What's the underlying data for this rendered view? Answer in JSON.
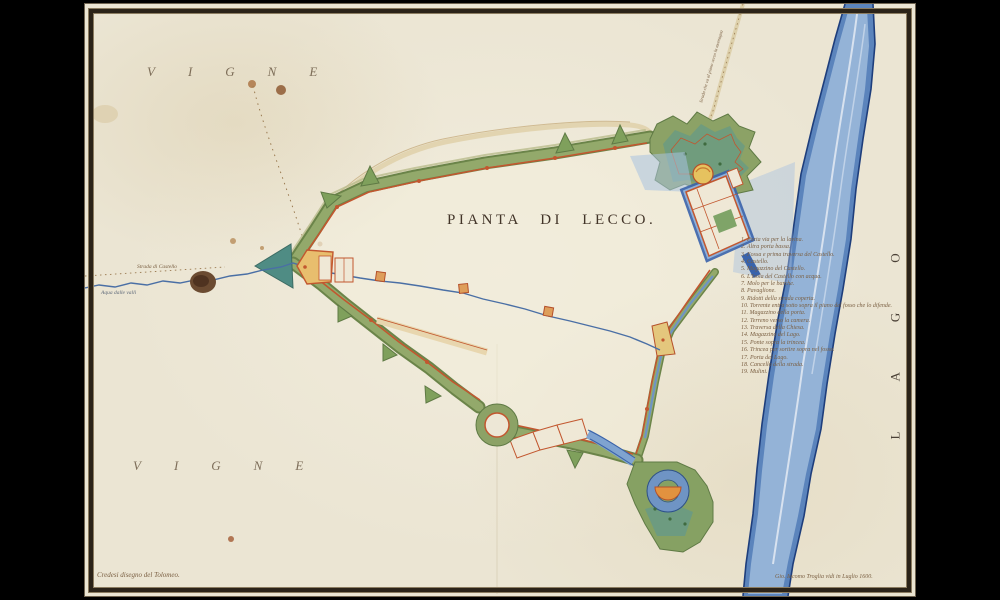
{
  "background_color": "#000000",
  "sheet": {
    "paper_color": "#EBE5D3",
    "frame_color": "#2B2318"
  },
  "map": {
    "title": "PIANTA DI LECCO.",
    "region_labels": {
      "vigne_top": "VIGNE",
      "vigne_bottom": "VIGNE",
      "lago": "LAGO"
    },
    "annotations": {
      "road_note": "Strada che va al piano verso la montagna",
      "strada_castello": "Strada di Castello",
      "aqua_valli": "Aqua dalle valli",
      "credit_left": "Credesi disegno del Tolomeo.",
      "credit_right": "Gio. Iacomo Troglia vidi in Luglio 1600."
    },
    "legend": {
      "items": [
        "1.  Porta via per la lavina.",
        "2.  Altra porta bassa.",
        "3.  Fossa e prima traversa del Castello.",
        "4.  Castello.",
        "5.  Magazzino del Castello.",
        "6.  L'Isola del Castello con acqua.",
        "7.  Molo per le barche.",
        "8.  Pavaglione.",
        "9.  Ridotti della strada coperta.",
        "10. Torrente entra sotto sopra il piano del fosso che lo difende.",
        "11. Magazzino della porta.",
        "12. Terreno verso la camera.",
        "13. Traversa della Chiesa.",
        "14. Magazzino del Lago.",
        "15. Ponte sopra la trincea.",
        "16. Trincea per sortire sopra nel fosso.",
        "17. Porta del Lago.",
        "18. Cancello della strada.",
        "19. Mulini."
      ]
    },
    "palette": {
      "rampart_green": "#8CA266",
      "glacis_teal": "#6D9B80",
      "wall_red": "#C2572F",
      "water_blue": "#5B84BC",
      "water_dark": "#1E3E7C",
      "building_yellow": "#E8C06A",
      "ink_sepia": "#7A5F42"
    }
  }
}
